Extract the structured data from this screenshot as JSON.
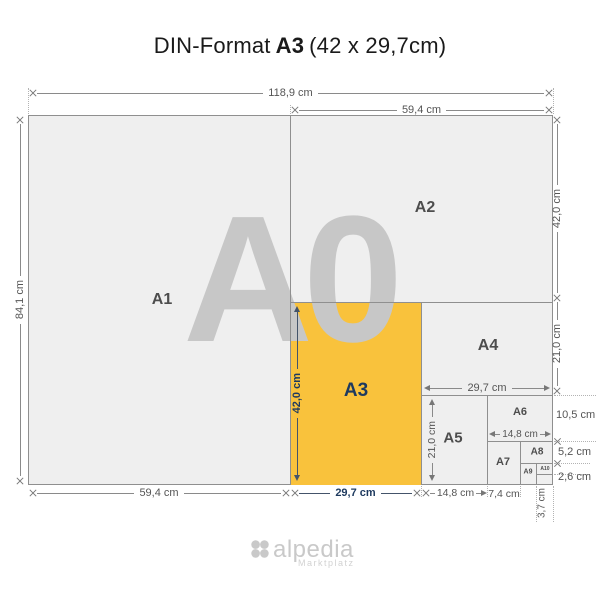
{
  "title": {
    "prefix": "DIN-Format",
    "format": "A3",
    "suffix": "(42 x 29,7cm)"
  },
  "diagram": {
    "watermark": "A0",
    "papers": {
      "a1": "A1",
      "a2": "A2",
      "a3": "A3",
      "a4": "A4",
      "a5": "A5",
      "a6": "A6",
      "a7": "A7",
      "a8": "A8",
      "a9": "A9",
      "a10": "A10"
    },
    "dimensions": {
      "top_total_width": "118,9 cm",
      "top_right_width": "59,4 cm",
      "left_total_height": "84,1 cm",
      "right_a2_height": "42,0 cm",
      "right_a4_height": "21,0 cm",
      "right_a6_height": "10,5 cm",
      "right_a8_height": "5,2 cm",
      "right_a10_height": "2,6 cm",
      "bottom_a1_width": "59,4 cm",
      "bottom_a3_width": "29,7 cm",
      "bottom_a5_width": "14,8 cm",
      "bottom_a7_width": "7,4 cm",
      "bottom_a9_width": "3,7 cm",
      "inner_a3_height": "42,0 cm",
      "inner_a4_width": "29,7 cm",
      "inner_a5_height": "21,0 cm",
      "inner_a6_width": "14,8 cm"
    }
  },
  "footer": {
    "brand": "alpedia",
    "tagline": "Marktplatz"
  },
  "colors": {
    "highlight": "#F9C23C",
    "accent_navy": "#1E3A5F",
    "paper_fill": "#EFEFEF",
    "line": "#8F8F8F",
    "watermark": "#C7C7C7",
    "label": "#4D4D4D",
    "dim_text": "#555555",
    "logo": "#C9C9C9"
  }
}
